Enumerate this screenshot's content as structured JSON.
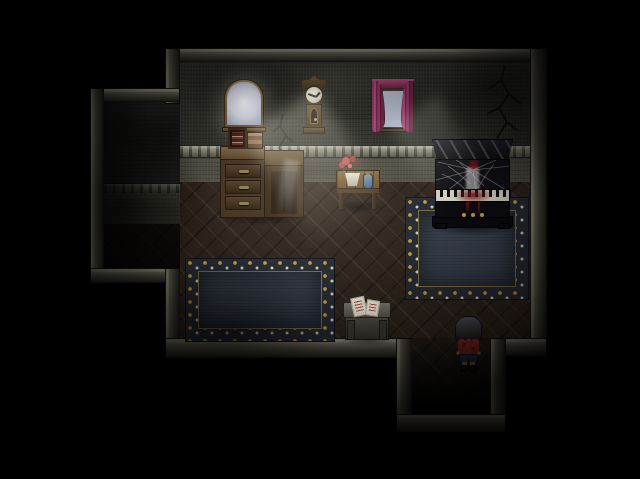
{
  "viewport": {
    "width": 640,
    "height": 479
  },
  "scene": {
    "type": "rpg-interior-screenshot",
    "labels": {
      "stage": "Dark haunted parlor room, top-down RPG view",
      "main_room": "main parlor room",
      "alcove": "dark alcove on west wall",
      "passage": "south passage exit",
      "arched_window": "arched wooden window with moonlight beam",
      "clock": "antique pendulum wall clock",
      "curtained_window": "window with magenta curtains",
      "crack": "cracked wall plaster",
      "desk": "wooden dresser with three drawers and cabinet door",
      "frame_box": "small framed case on dresser top",
      "books": "stacked books on dresser top",
      "side_table": "small wooden table",
      "roses": "potted red roses",
      "jar": "blue jar",
      "piano": "black upright piano covered in cobwebs with blood on the keys",
      "left_rug": "ornate navy rug with gold border",
      "right_rug": "ornate navy rug with gold border",
      "storage_box": "stone chest with handwritten notes",
      "notes": "notes written in red ink",
      "character": "player character in red shirt and blue shorts, seen from behind"
    },
    "colors": {
      "bg": "#000000",
      "wall_face": "#30312a",
      "trim_light": "#8f8d7c",
      "wainscot": "#4e4e42",
      "floor": "#2e241c",
      "rug_center": "#38404d",
      "rug_border_bg": "#262a33",
      "rug_gold": "#c69a35",
      "rug_ivory": "#cfc9b4",
      "curtain": "#8e2f5e",
      "piano_key": "#cfccc2",
      "blood": "#6a1212",
      "pedal_gold": "#c09a4a",
      "char_shirt": "#a82f2c",
      "char_shorts": "#2c3f66",
      "char_skin": "#d9a877",
      "char_shoe": "#1d1d20"
    }
  }
}
